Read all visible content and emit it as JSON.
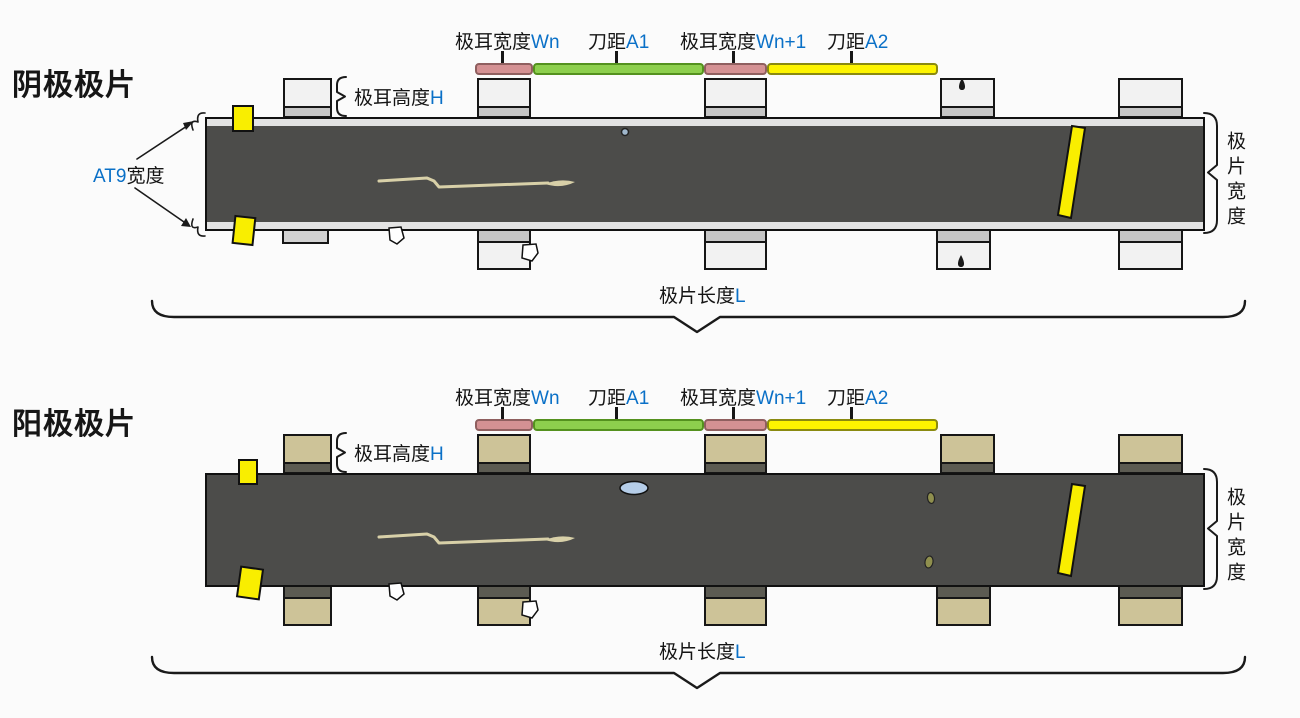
{
  "titles": {
    "cathode": "阴极极片",
    "anode": "阳极极片"
  },
  "annotations": {
    "tab_width_n": {
      "text": "极耳宽度",
      "var": "Wn"
    },
    "knife_gap_1": {
      "text": "刀距",
      "var": "A1"
    },
    "tab_width_n_plus_1": {
      "text": "极耳宽度",
      "var": "Wn+1"
    },
    "knife_gap_2": {
      "text": "刀距",
      "var": "A2"
    },
    "tab_height": {
      "text": "极耳高度",
      "var": "H"
    },
    "at9_width": {
      "var": "AT9",
      "text": "宽度"
    },
    "sheet_width": {
      "text": "极片宽度"
    },
    "sheet_length": {
      "text": "极片长度",
      "var": "L"
    }
  },
  "marks": {
    "yellow_edge": "yellow-edge-mark",
    "yellow_slant": "yellow-slant-mark",
    "scratch": "scratch-mark",
    "pinhole": "pinhole-mark",
    "droplet": "droplet-mark",
    "notch": "notch-mark",
    "blue_bubble": "blue-bubble-mark",
    "olive_speck": "olive-speck-mark"
  },
  "theme": {
    "bg": "#fbfbfb",
    "ink": "#1a1a1a",
    "accent-blue": "#0a70c7",
    "strip-dark": "#4c4c4a",
    "cathode-tab": "#f2f2f2",
    "cathode-band": "#c6c6c6",
    "cathode-edge": "#e3e3e3",
    "anode-tab": "#cdc398",
    "anode-band": "#5c5b52",
    "bar-pink": "#d49193",
    "bar-green": "#8dcf4d",
    "bar-yellow": "#fdf400",
    "defect-yellow": "#f9ee00",
    "defect-blue": "#b5cde8",
    "scratch": "#d8d0a8"
  }
}
